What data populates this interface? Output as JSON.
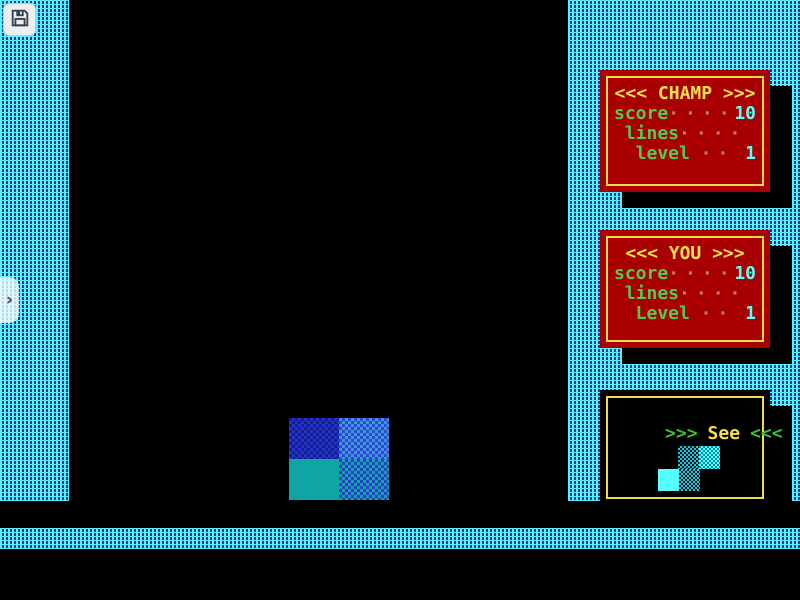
{
  "overlay": {
    "save_button": {
      "icon": "floppy-disk-icon"
    },
    "sidebar_handle": {
      "glyph": "›"
    }
  },
  "panels": {
    "champ": {
      "title": "<<< CHAMP >>>",
      "rows": [
        {
          "label": "score",
          "dots": "·····",
          "value": "10"
        },
        {
          "label": " lines",
          "dots": "·····",
          "value": ""
        },
        {
          "label": "  level",
          "dots": "··",
          "value": "1"
        }
      ]
    },
    "you": {
      "title": "<<< YOU >>>",
      "rows": [
        {
          "label": "score",
          "dots": "·····",
          "value": "10"
        },
        {
          "label": " lines",
          "dots": "·····",
          "value": ""
        },
        {
          "label": "  Level",
          "dots": "··",
          "value": "1"
        }
      ]
    },
    "next": {
      "arrows_left": ">>>",
      "word": "See",
      "arrows_right": "<<<",
      "piece": "s-piece-cyan"
    }
  },
  "game": {
    "falling_piece": "square-piece-blue-teal"
  },
  "colors": {
    "panel_red": "#A80000",
    "border_yellow": "#F2DC4E",
    "title_yellow": "#F5E04E",
    "label_green": "#55C94F",
    "value_cyan": "#55FFFF",
    "frame_texture_cyan": "#5BEFFF",
    "frame_texture_blue": "#1638AC",
    "block_blue": "#2433C8",
    "block_teal": "#0FA5A5"
  }
}
